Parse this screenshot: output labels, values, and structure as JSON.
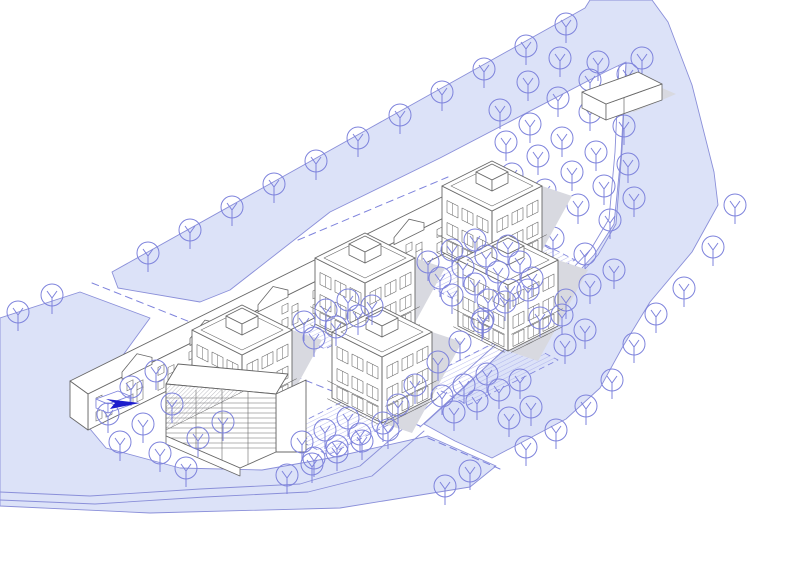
{
  "meta": {
    "title": "Axonometric site plan - residential blocks between canals",
    "canvas": {
      "w": 800,
      "h": 565
    }
  },
  "palette": {
    "background": "#ffffff",
    "water_fill": "#dce2f8",
    "water_stroke": "#8a8fd9",
    "vegetation": "#7e83dc",
    "hatch": "#979ce6",
    "dashed_path": "#7e83dc",
    "building_line": "#686868",
    "building_fill": "#ffffff",
    "shadow": "#d8d9e0",
    "arrow": "#1c1ccc"
  },
  "water": {
    "main_canal": [
      [
        112,
        272
      ],
      [
        585,
        8
      ],
      [
        590,
        0
      ],
      [
        652,
        0
      ],
      [
        668,
        22
      ],
      [
        692,
        85
      ],
      [
        714,
        172
      ],
      [
        718,
        205
      ],
      [
        692,
        252
      ],
      [
        650,
        302
      ],
      [
        622,
        348
      ],
      [
        600,
        388
      ],
      [
        566,
        419
      ],
      [
        530,
        438
      ],
      [
        492,
        458
      ],
      [
        455,
        441
      ],
      [
        424,
        424
      ],
      [
        470,
        382
      ],
      [
        513,
        341
      ],
      [
        557,
        295
      ],
      [
        594,
        255
      ],
      [
        614,
        224
      ],
      [
        621,
        155
      ],
      [
        626,
        62
      ],
      [
        605,
        72
      ],
      [
        440,
        158
      ],
      [
        330,
        212
      ],
      [
        230,
        290
      ],
      [
        200,
        302
      ],
      [
        118,
        288
      ]
    ],
    "pond": [
      [
        0,
        318
      ],
      [
        80,
        292
      ],
      [
        150,
        318
      ],
      [
        118,
        362
      ],
      [
        88,
        400
      ],
      [
        80,
        417
      ],
      [
        106,
        448
      ],
      [
        180,
        468
      ],
      [
        262,
        470
      ],
      [
        330,
        458
      ],
      [
        428,
        436
      ],
      [
        496,
        466
      ],
      [
        470,
        487
      ],
      [
        340,
        508
      ],
      [
        150,
        513
      ],
      [
        0,
        506
      ]
    ]
  },
  "paths": {
    "solid": [
      [
        [
          420,
          427
        ],
        [
          513,
          342
        ],
        [
          560,
          296
        ],
        [
          598,
          255
        ],
        [
          616,
          224
        ],
        [
          622,
          150
        ],
        [
          626,
          64
        ]
      ],
      [
        [
          413,
          420
        ],
        [
          506,
          335
        ],
        [
          553,
          289
        ],
        [
          591,
          249
        ],
        [
          609,
          219
        ],
        [
          615,
          152
        ],
        [
          619,
          66
        ]
      ],
      [
        [
          0,
          492
        ],
        [
          90,
          496
        ],
        [
          200,
          489
        ],
        [
          300,
          484
        ],
        [
          360,
          466
        ],
        [
          413,
          420
        ]
      ],
      [
        [
          0,
          500
        ],
        [
          95,
          504
        ],
        [
          205,
          497
        ],
        [
          308,
          492
        ],
        [
          372,
          476
        ],
        [
          424,
          431
        ]
      ]
    ],
    "dashed": [
      [
        [
          92,
          283
        ],
        [
          248,
          345
        ]
      ],
      [
        [
          428,
          438
        ],
        [
          500,
          469
        ]
      ],
      [
        [
          183,
          331
        ],
        [
          292,
          375
        ],
        [
          420,
          426
        ]
      ],
      [
        [
          298,
          240
        ],
        [
          448,
          177
        ]
      ]
    ]
  },
  "courtyards": [
    {
      "pts": [
        [
          287,
          330
        ],
        [
          352,
          297
        ],
        [
          390,
          316
        ],
        [
          325,
          349
        ]
      ]
    },
    {
      "pts": [
        [
          420,
          282
        ],
        [
          520,
          232
        ],
        [
          575,
          260
        ],
        [
          475,
          310
        ]
      ]
    },
    {
      "pts": [
        [
          282,
          432
        ],
        [
          352,
          397
        ],
        [
          398,
          420
        ],
        [
          328,
          455
        ]
      ]
    },
    {
      "pts": [
        [
          420,
          380
        ],
        [
          510,
          335
        ],
        [
          558,
          360
        ],
        [
          468,
          405
        ]
      ]
    }
  ],
  "vegetation": {
    "radius": 11,
    "back": [
      [
        148,
        253
      ],
      [
        190,
        230
      ],
      [
        232,
        207
      ],
      [
        274,
        184
      ],
      [
        316,
        161
      ],
      [
        358,
        138
      ],
      [
        400,
        115
      ],
      [
        442,
        92
      ],
      [
        484,
        69
      ],
      [
        526,
        46
      ],
      [
        566,
        24
      ],
      [
        642,
        58
      ],
      [
        598,
        62
      ],
      [
        628,
        74
      ],
      [
        560,
        58
      ],
      [
        590,
        80
      ],
      [
        622,
        95
      ],
      [
        528,
        82
      ],
      [
        558,
        98
      ],
      [
        590,
        112
      ],
      [
        624,
        126
      ],
      [
        500,
        110
      ],
      [
        530,
        124
      ],
      [
        562,
        138
      ],
      [
        596,
        152
      ],
      [
        628,
        164
      ],
      [
        506,
        142
      ],
      [
        538,
        156
      ],
      [
        572,
        172
      ],
      [
        604,
        186
      ],
      [
        634,
        198
      ],
      [
        512,
        174
      ],
      [
        545,
        190
      ],
      [
        578,
        205
      ],
      [
        610,
        220
      ],
      [
        488,
        196
      ],
      [
        520,
        222
      ],
      [
        553,
        238
      ],
      [
        585,
        254
      ],
      [
        614,
        270
      ]
    ],
    "front": [
      [
        52,
        295
      ],
      [
        18,
        312
      ],
      [
        131,
        387
      ],
      [
        156,
        371
      ],
      [
        108,
        414
      ],
      [
        143,
        424
      ],
      [
        172,
        404
      ],
      [
        198,
        438
      ],
      [
        223,
        422
      ],
      [
        160,
        453
      ],
      [
        186,
        468
      ],
      [
        120,
        442
      ],
      [
        304,
        322
      ],
      [
        326,
        310
      ],
      [
        348,
        300
      ],
      [
        314,
        338
      ],
      [
        336,
        327
      ],
      [
        358,
        316
      ],
      [
        372,
        306
      ],
      [
        428,
        262
      ],
      [
        452,
        250
      ],
      [
        475,
        240
      ],
      [
        440,
        278
      ],
      [
        463,
        267
      ],
      [
        486,
        256
      ],
      [
        508,
        246
      ],
      [
        452,
        295
      ],
      [
        475,
        284
      ],
      [
        498,
        272
      ],
      [
        520,
        262
      ],
      [
        488,
        300
      ],
      [
        510,
        290
      ],
      [
        532,
        278
      ],
      [
        302,
        442
      ],
      [
        325,
        430
      ],
      [
        348,
        418
      ],
      [
        314,
        458
      ],
      [
        337,
        446
      ],
      [
        360,
        434
      ],
      [
        383,
        423
      ],
      [
        442,
        396
      ],
      [
        464,
        385
      ],
      [
        487,
        374
      ],
      [
        454,
        412
      ],
      [
        477,
        401
      ],
      [
        499,
        390
      ],
      [
        520,
        380
      ],
      [
        509,
        418
      ],
      [
        531,
        407
      ],
      [
        505,
        302
      ],
      [
        528,
        290
      ],
      [
        482,
        322
      ],
      [
        460,
        342
      ],
      [
        438,
        362
      ],
      [
        415,
        385
      ],
      [
        398,
        405
      ],
      [
        483,
        319
      ],
      [
        562,
        315
      ],
      [
        585,
        330
      ],
      [
        565,
        345
      ],
      [
        590,
        285
      ],
      [
        566,
        300
      ],
      [
        540,
        318
      ],
      [
        287,
        475
      ],
      [
        312,
        464
      ],
      [
        337,
        452
      ],
      [
        362,
        441
      ],
      [
        388,
        430
      ],
      [
        445,
        486
      ],
      [
        470,
        471
      ],
      [
        735,
        205
      ],
      [
        713,
        247
      ],
      [
        684,
        288
      ],
      [
        656,
        314
      ],
      [
        634,
        344
      ],
      [
        612,
        380
      ],
      [
        586,
        406
      ],
      [
        556,
        430
      ],
      [
        526,
        447
      ]
    ]
  },
  "buildings": {
    "cubes": [
      {
        "cx": 492,
        "cy": 186
      },
      {
        "cx": 365,
        "cy": 258
      },
      {
        "cx": 508,
        "cy": 260
      },
      {
        "cx": 242,
        "cy": 330
      },
      {
        "cx": 382,
        "cy": 332
      }
    ],
    "cube_spec": {
      "roof_hw": 50,
      "roof_hh": 25,
      "wall_h": 66,
      "bulkhead_hw": 16,
      "bulkhead_hh": 8,
      "bulkhead_side": 11
    },
    "terrace": {
      "x0": 88,
      "x1": 466,
      "base_y0": 430,
      "slope": -0.4947,
      "wall_h": 36,
      "roof_dx": -18,
      "roof_dy": -13,
      "gable_xs": [
        122,
        190,
        258,
        326,
        394
      ],
      "window_step": 31
    },
    "louver_building": {
      "roof": [
        [
          166,
          384
        ],
        [
          276,
          394
        ],
        [
          288,
          374
        ],
        [
          178,
          364
        ]
      ],
      "front_face": [
        [
          166,
          384
        ],
        [
          276,
          394
        ],
        [
          276,
          452
        ],
        [
          240,
          468
        ],
        [
          166,
          436
        ]
      ],
      "hatch_wedge": [
        [
          166,
          384
        ],
        [
          244,
          391
        ],
        [
          166,
          430
        ]
      ],
      "right_wing": [
        [
          276,
          394
        ],
        [
          306,
          380
        ],
        [
          306,
          452
        ],
        [
          276,
          452
        ]
      ],
      "plinth": [
        [
          166,
          436
        ],
        [
          240,
          468
        ],
        [
          240,
          476
        ],
        [
          166,
          444
        ]
      ],
      "slat_top": 398,
      "slat_bottom": 450,
      "slat_step": 5,
      "mullion_xs": [
        196,
        222,
        248
      ]
    },
    "pavilion": {
      "roof": [
        [
          582,
          92
        ],
        [
          638,
          72
        ],
        [
          662,
          84
        ],
        [
          606,
          104
        ]
      ],
      "wall_h": 16,
      "shadow": [
        [
          662,
          88
        ],
        [
          676,
          94
        ],
        [
          634,
          112
        ],
        [
          620,
          106
        ]
      ]
    },
    "kiosk": {
      "roof": [
        [
          96,
          399
        ],
        [
          118,
          391
        ],
        [
          130,
          396
        ],
        [
          108,
          404
        ]
      ],
      "wall_h": 9
    }
  },
  "marker": {
    "arrow_pts": [
      [
        106,
        399
      ],
      [
        140,
        403
      ],
      [
        110,
        409
      ],
      [
        115,
        403
      ]
    ]
  }
}
